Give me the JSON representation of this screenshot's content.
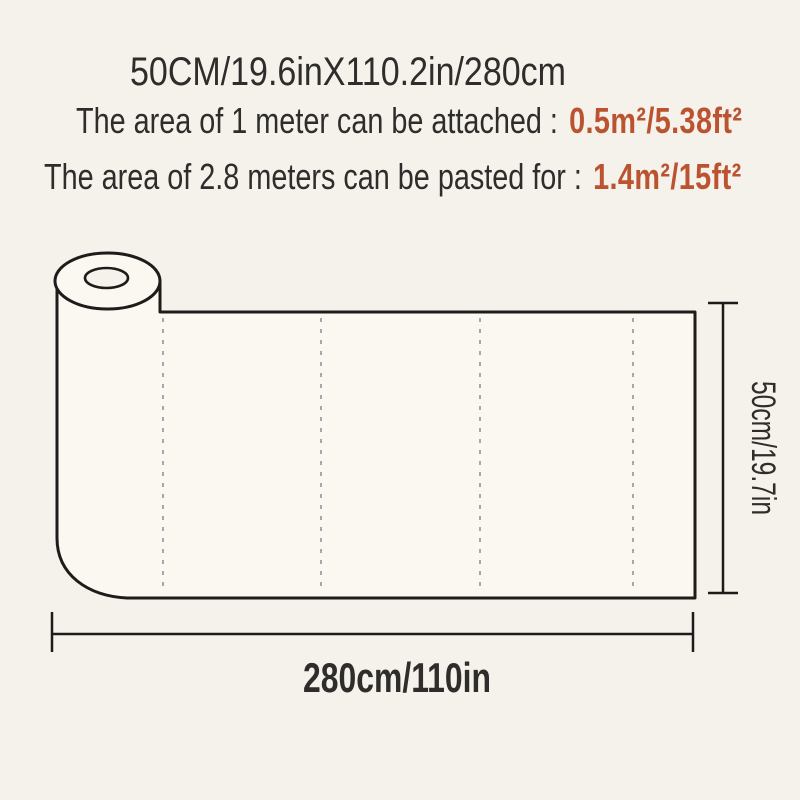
{
  "header": {
    "title": "50CM/19.6inX110.2in/280cm"
  },
  "specs": [
    {
      "label": "The area of 1 meter can be attached :",
      "value": "0.5m²/5.38ft²"
    },
    {
      "label": "The area of 2.8 meters can be pasted for :",
      "value": "1.4m²/15ft²"
    }
  ],
  "diagram": {
    "width_label": "280cm/110in",
    "height_label": "50cm/19.7in"
  },
  "colors": {
    "background": "#f5f2eb",
    "paper": "#fbf8f2",
    "text": "#2e2d2b",
    "accent": "#bb5331",
    "line": "#1d1c1a",
    "dash": "#8f959d"
  }
}
